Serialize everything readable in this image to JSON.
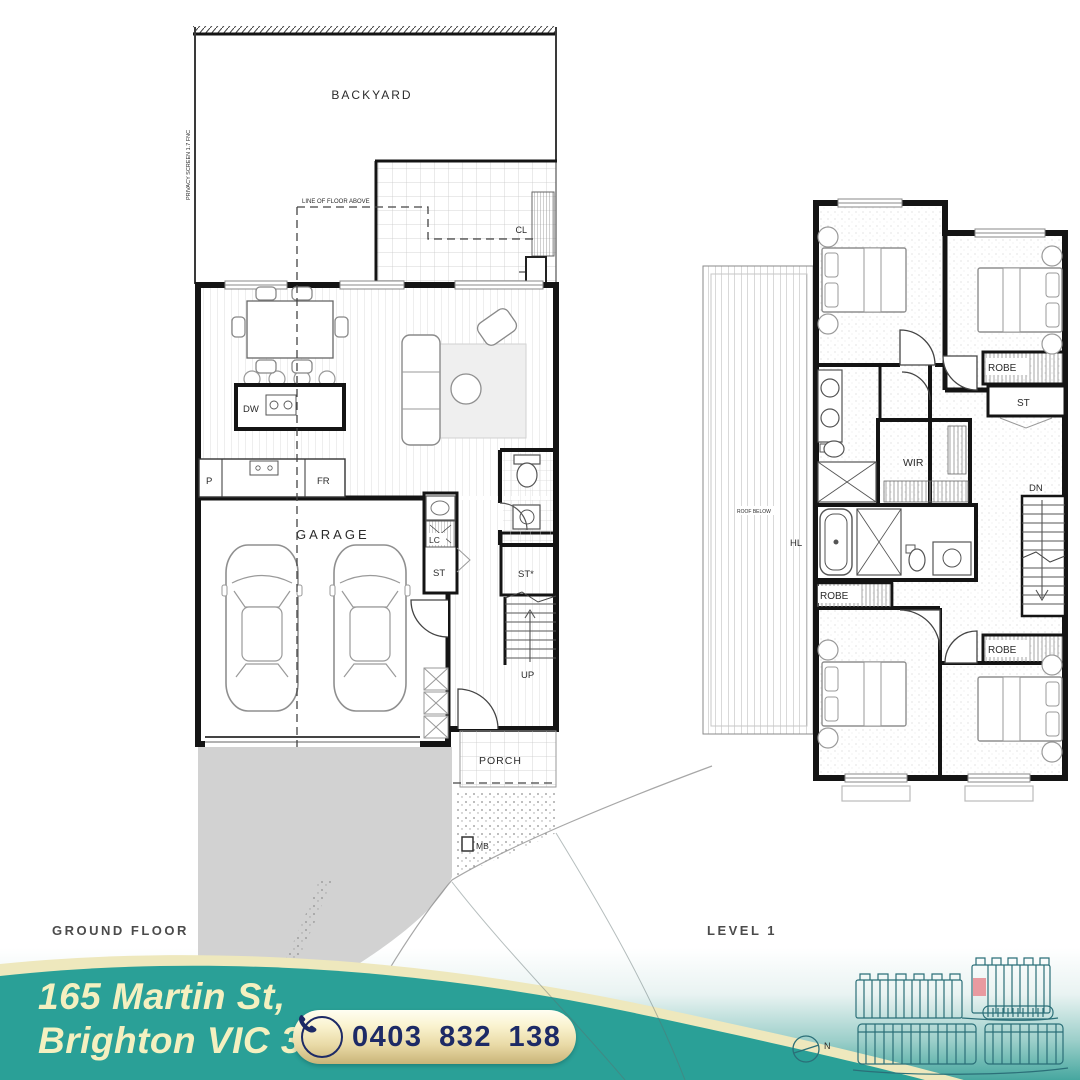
{
  "ground_floor": {
    "title": "GROUND FLOOR",
    "labels": {
      "backyard": "BACKYARD",
      "privacy_screen": "PRIVACY SCREEN 1.7 FNC",
      "line_of_floor_above": "LINE OF FLOOR ABOVE",
      "cl": "CL",
      "ac": "A/C",
      "dw": "DW",
      "p": "P",
      "fr": "FR",
      "garage": "GARAGE",
      "lc": "LC",
      "st": "ST",
      "st_star": "ST*",
      "up": "UP",
      "porch": "PORCH",
      "mb": "MB"
    }
  },
  "level_1": {
    "title": "LEVEL 1",
    "labels": {
      "roof_below": "ROOF BELOW",
      "hl": "HL",
      "wir": "WIR",
      "dn": "DN",
      "robe": "ROBE",
      "st": "ST"
    }
  },
  "footer": {
    "address_line_1": "165 Martin St,",
    "address_line_2": "Brighton VIC 3186",
    "phone": "0403 832 138",
    "compass_label": "N"
  },
  "colors": {
    "teal_arc": "#2AA097",
    "banner_teal_deep": "#46A79F",
    "cream_band": "#EEE8BD",
    "cream_text": "#F4F0C0",
    "pill_gold_top": "#FFFEF2",
    "pill_gold_bottom": "#C9B478",
    "navy": "#1D2A66",
    "driveway_gray": "#D2D2D2",
    "plan_line": "#141414",
    "site_outline": "#2B6F78",
    "unit_highlight": "#E89AA0"
  }
}
